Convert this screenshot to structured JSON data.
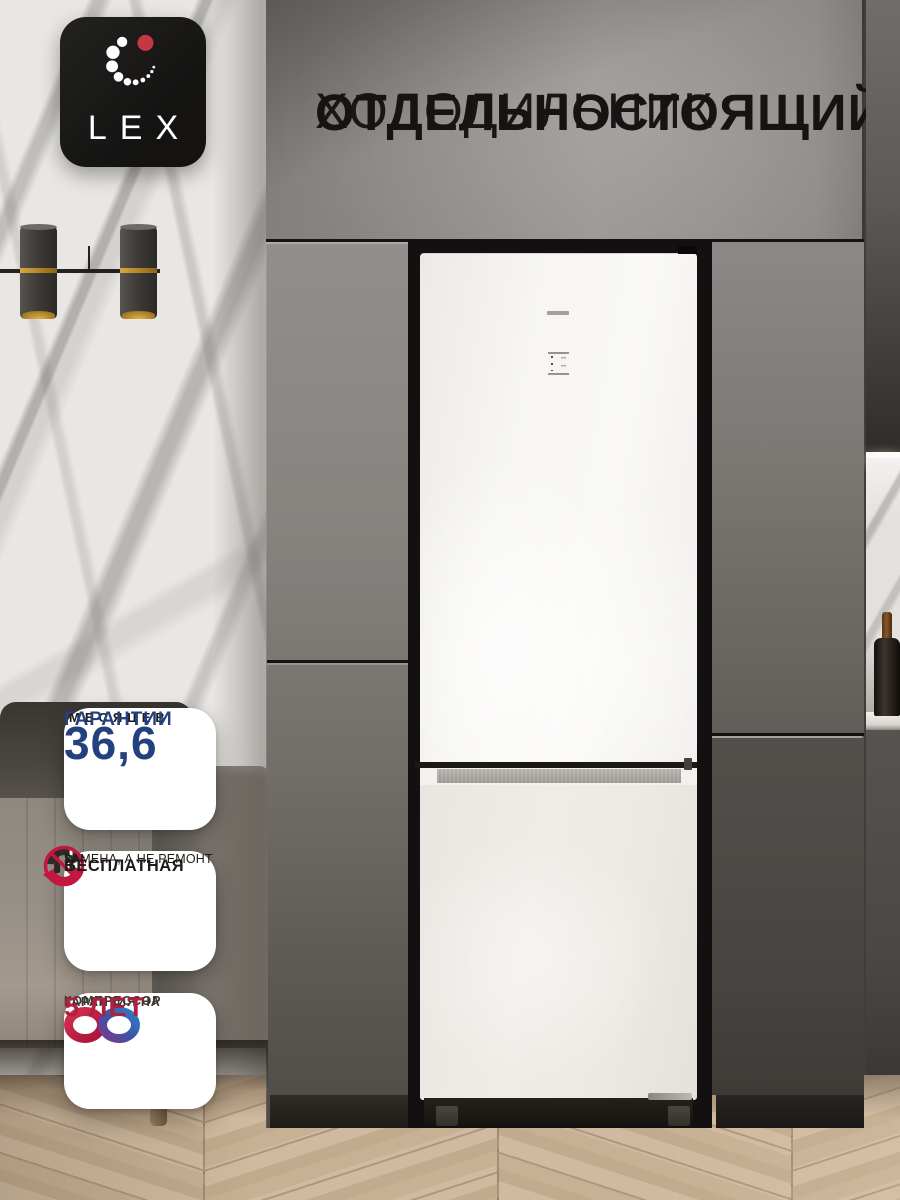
{
  "brand": {
    "logo_text": "LEX"
  },
  "title": {
    "line1": "ХОЛОДИЛЬНИК",
    "line2": "ОТДЕЛЬНОСТОЯЩИЙ"
  },
  "badges": {
    "warranty": {
      "value": "36,6",
      "unit": "МЕСЯЦЕВ",
      "label": "ГАРАНТИИ"
    },
    "replacement": {
      "title": "БЕСПЛАТНАЯ",
      "subtitle": "ЗАМЕНА, А НЕ РЕМОНТ"
    },
    "compressor": {
      "line1": "ГАРАНТИЯ НА",
      "line2": "КОМПРЕССОР",
      "value": "5 ЛЕТ"
    }
  },
  "colors": {
    "accent_red": "#c2183f",
    "navy_blue": "#24407e",
    "crimson_text": "#b01f3e",
    "badge_background": "#ffffff",
    "title_text": "#1b1918"
  }
}
